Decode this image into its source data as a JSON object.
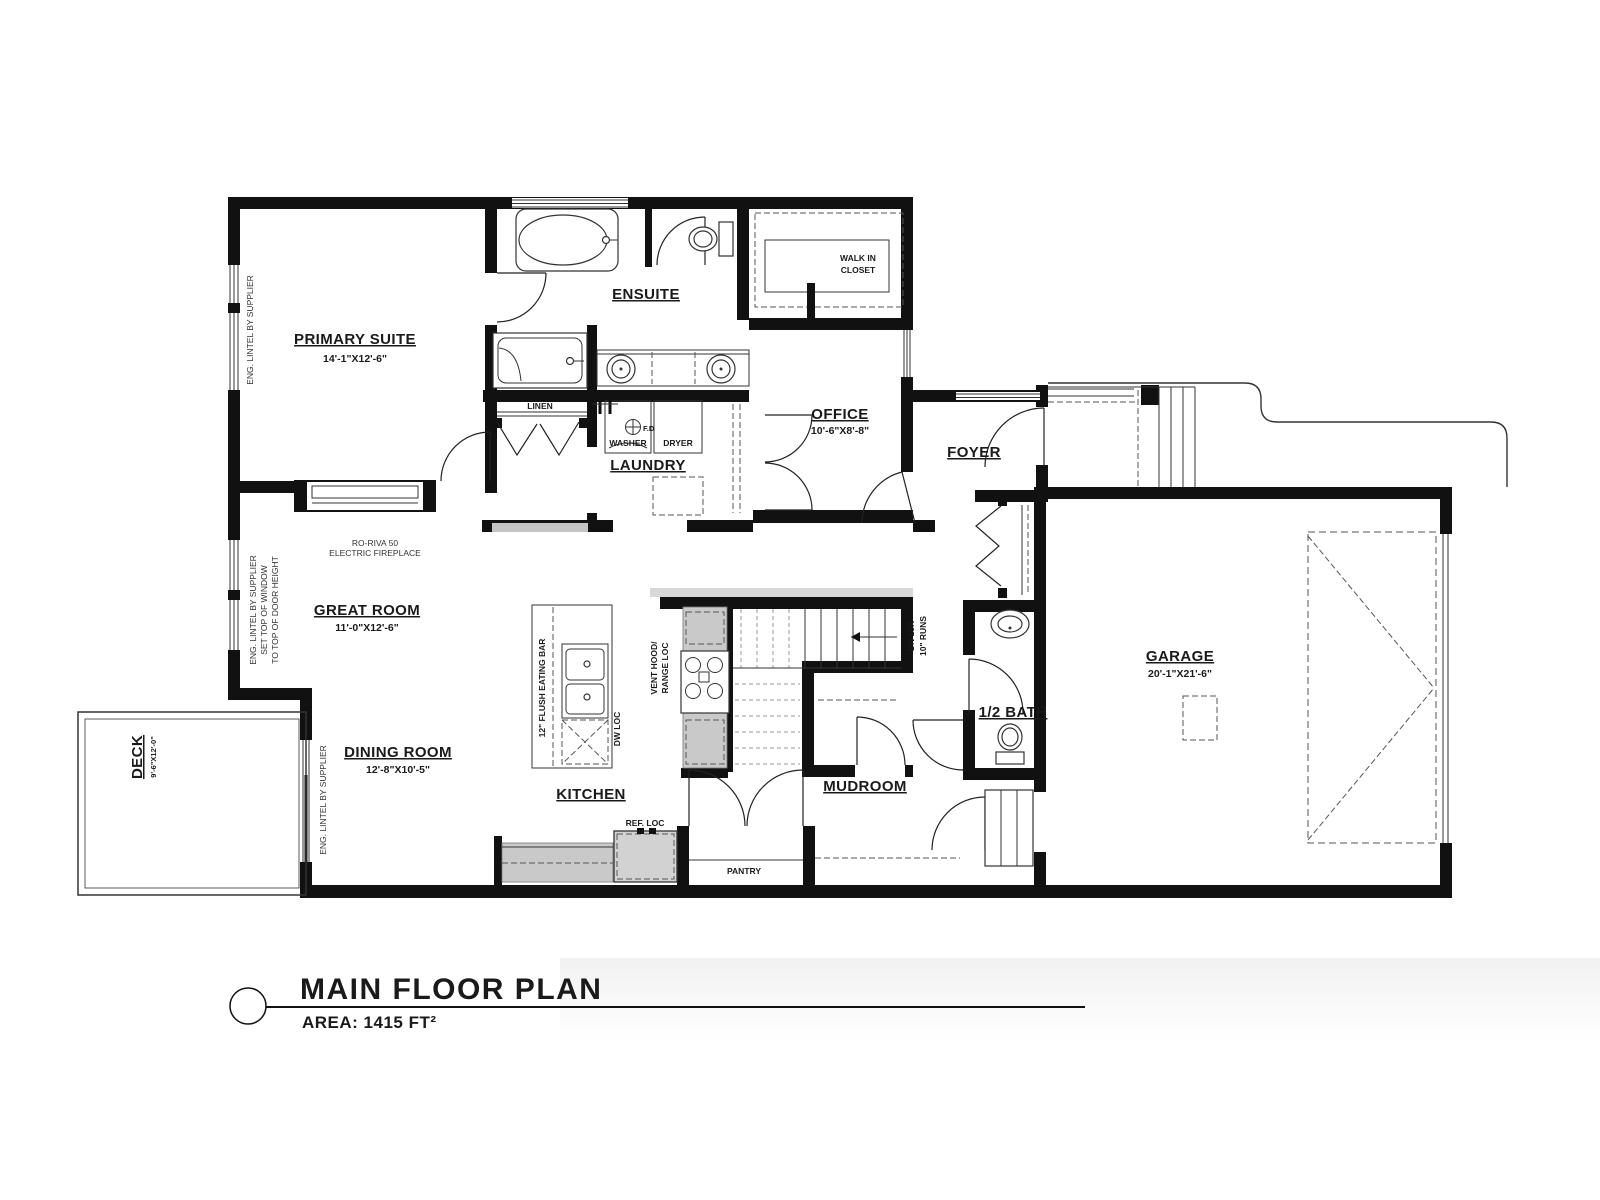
{
  "title_block": {
    "title": "MAIN FLOOR PLAN",
    "area_label": "AREA: 1415 FT²"
  },
  "rooms": {
    "primary_suite": {
      "label": "PRIMARY SUITE",
      "dims": "14'-1\"X12'-6\""
    },
    "ensuite": {
      "label": "ENSUITE"
    },
    "walk_in_closet": {
      "line1": "WALK IN",
      "line2": "CLOSET"
    },
    "office": {
      "label": "OFFICE",
      "dims": "10'-6\"X8'-8\""
    },
    "foyer": {
      "label": "FOYER"
    },
    "linen": {
      "label": "LINEN"
    },
    "laundry": {
      "label": "LAUNDRY"
    },
    "great_room": {
      "label": "GREAT ROOM",
      "dims": "11'-0\"X12'-6\""
    },
    "dining_room": {
      "label": "DINING ROOM",
      "dims": "12'-8\"X10'-5\""
    },
    "kitchen": {
      "label": "KITCHEN"
    },
    "pantry": {
      "label": "PANTRY"
    },
    "mudroom": {
      "label": "MUDROOM"
    },
    "half_bath": {
      "label": "1/2 BATH"
    },
    "garage": {
      "label": "GARAGE",
      "dims": "20'-1\"X21'-6\""
    },
    "deck": {
      "label": "DECK",
      "dims": "9'-6\"X12'-0\""
    }
  },
  "appliances": {
    "washer": "WASHER",
    "dryer": "DRYER",
    "floor_drain": "F.D",
    "fridge": "REF. LOC",
    "dishwasher": "DW LOC",
    "vent_hood_line1": "VENT HOOD/",
    "vent_hood_line2": "RANGE LOC",
    "eating_bar": "12\" FLUSH EATING BAR"
  },
  "stairs": {
    "line1": "DN 15R",
    "line2": "10\" RUNS"
  },
  "notes": {
    "fireplace_line1": "RO-RIVA 50",
    "fireplace_line2": "ELECTRIC FIREPLACE",
    "lintel_primary": "ENG. LINTEL BY SUPPLIER",
    "lintel_great_line1": "ENG. LINTEL BY SUPPLIER",
    "lintel_great_line2": "SET TOP OF WINDOW",
    "lintel_great_line3": "TO TOP OF DOOR HEIGHT",
    "lintel_deck": "ENG. LINTEL BY SUPPLIER"
  }
}
